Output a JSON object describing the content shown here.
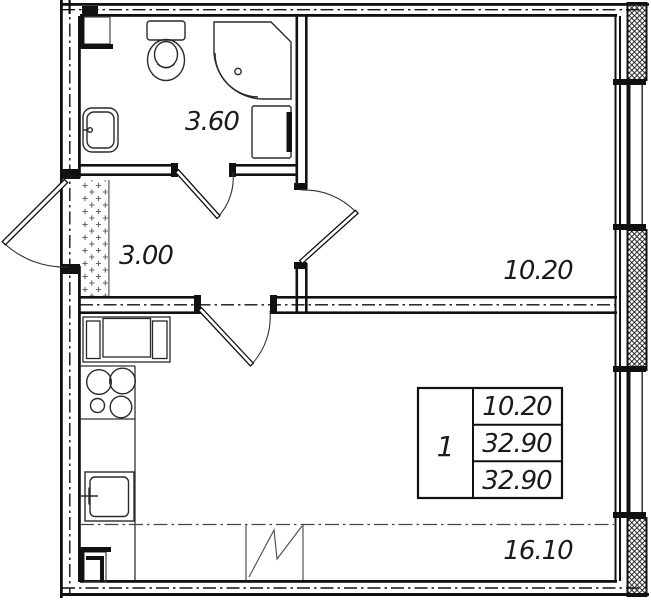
{
  "plan": {
    "title": "1-room apartment floor plan",
    "colors": {
      "line": "#111111",
      "bg": "#ffffff"
    },
    "rooms": [
      {
        "name": "bathroom",
        "area": "3.60"
      },
      {
        "name": "hallway",
        "area": "3.00"
      },
      {
        "name": "room",
        "area": "10.20"
      },
      {
        "name": "kitchen-living-room",
        "area": "16.10"
      }
    ],
    "info_table": {
      "rooms_count": "1",
      "living_area": "10.20",
      "total_area": "32.90",
      "total_area_with_balcony": "32.90"
    }
  }
}
